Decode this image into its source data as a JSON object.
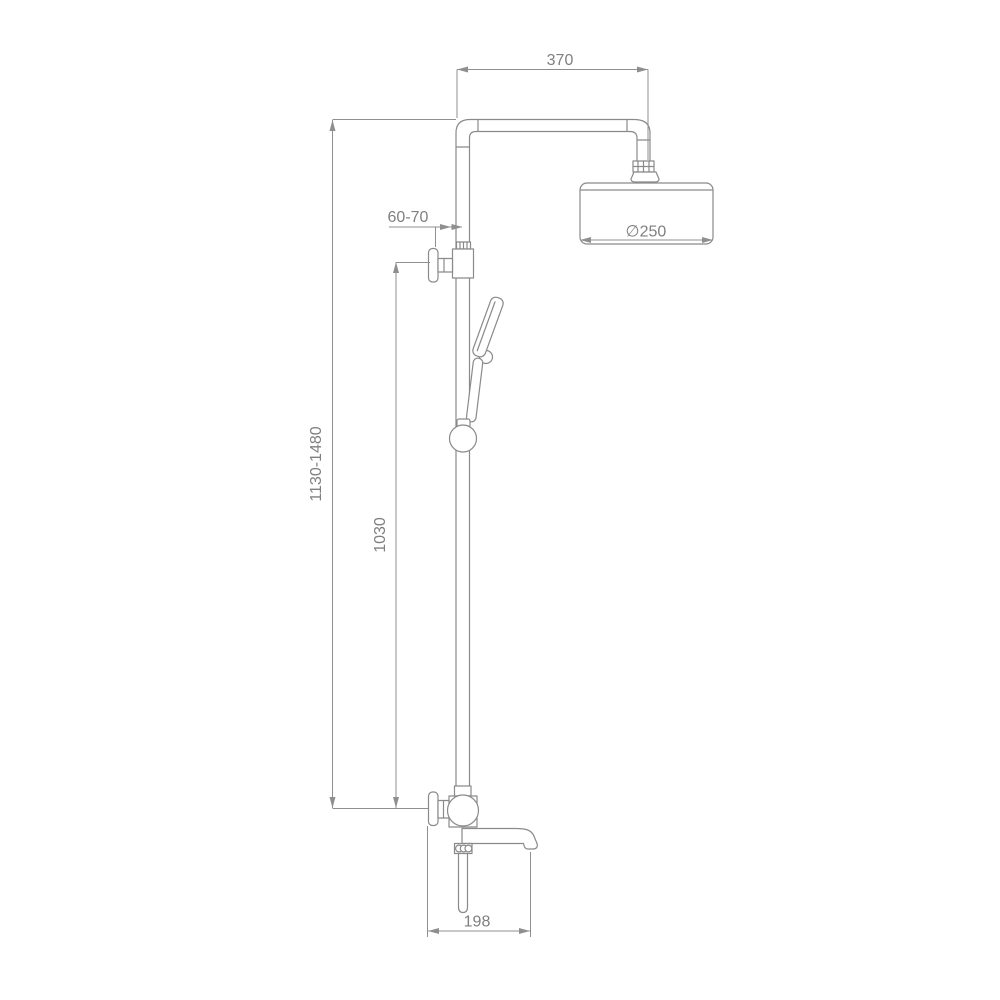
{
  "drawing": {
    "title": "shower-column-technical-drawing",
    "dimensions": {
      "top_arm_width": "370",
      "head_diameter": "∅250",
      "wall_offset": "60-70",
      "overall_height": "1130-1480",
      "column_height": "1030",
      "spout_length": "198"
    },
    "colors": {
      "line": "#8a8a8a",
      "dimension_line": "#8f8f8f",
      "text": "#7f7f7f",
      "background": "#ffffff"
    }
  }
}
